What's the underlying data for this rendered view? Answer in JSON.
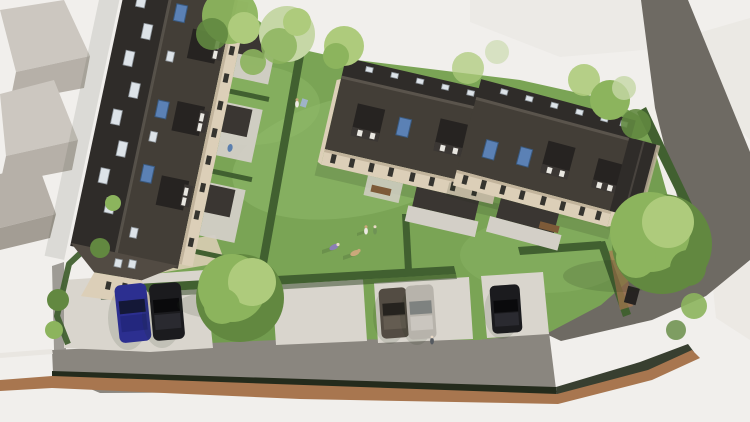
{
  "scene": {
    "title": "Aerial CGI render of a residential housing development",
    "description": "Top-down architectural visualisation: a long terraced block on the left, two terraced house blocks centre-right with dormers and rooflights, communal lawn with people, garden patios with canopies, hedged boundaries, parking bays with five cars, an access road with brown verge strip, a garden shed and mature trees; untextured white context buildings around the site",
    "buildings": [
      "left-terrace-block",
      "centre-house-block",
      "right-house-block",
      "garden-shed",
      "grey-context-buildings",
      "white-ghost-buildings"
    ],
    "vehicles": [
      "blue-car",
      "black-car",
      "taupe-car",
      "silver-car",
      "black-car"
    ],
    "people_visible": 7,
    "interactive": false
  },
  "colors": {
    "ground": "#f1efec",
    "ghost": "#f0eee9",
    "ghost_shade": "#e7e4df",
    "ctx_wall": "#b6b0a8",
    "ctx_roof": "#ccc7c0",
    "ctx_side": "#a39d94",
    "lawn": "#7aa455",
    "lawn_light": "#90ba6b",
    "lawn_dark": "#648f46",
    "hedge": "#416030",
    "hedge_shadow": "#2c4220",
    "hedge_strip": "#242b1c",
    "tree_light": "#aecb7c",
    "tree_mid": "#8cb45d",
    "tree_dark": "#628840",
    "tree_pale": "#c6d7a6",
    "road": "#8a867f",
    "road_dark": "#6e6a63",
    "curb_brown": "#a8764f",
    "paving": "#d9d5cd",
    "paving_warm": "#d9cdb4",
    "roof_dark": "#2f2c29",
    "roof_mid": "#433e37",
    "roof_light": "#524b43",
    "ridge": "#5a544c",
    "dormer": "#262321",
    "dormer_face": "#3b3734",
    "wall_cream": "#dccfb8",
    "wall_shade": "#c2b49c",
    "window_dark": "#35342f",
    "window_frame": "#e9e7e1",
    "skylight_white": "#dde3e8",
    "skylight_blue": "#5b81b5",
    "canopy": "#3a3632",
    "patio": "#d3cfc7",
    "bench": "#7d5a38",
    "car_blue": "#2c2f90",
    "car_black": "#1b1b1e",
    "car_silver": "#b7b3ab",
    "car_taupe": "#534c43",
    "shadow": "rgba(35,48,28,0.30)"
  }
}
